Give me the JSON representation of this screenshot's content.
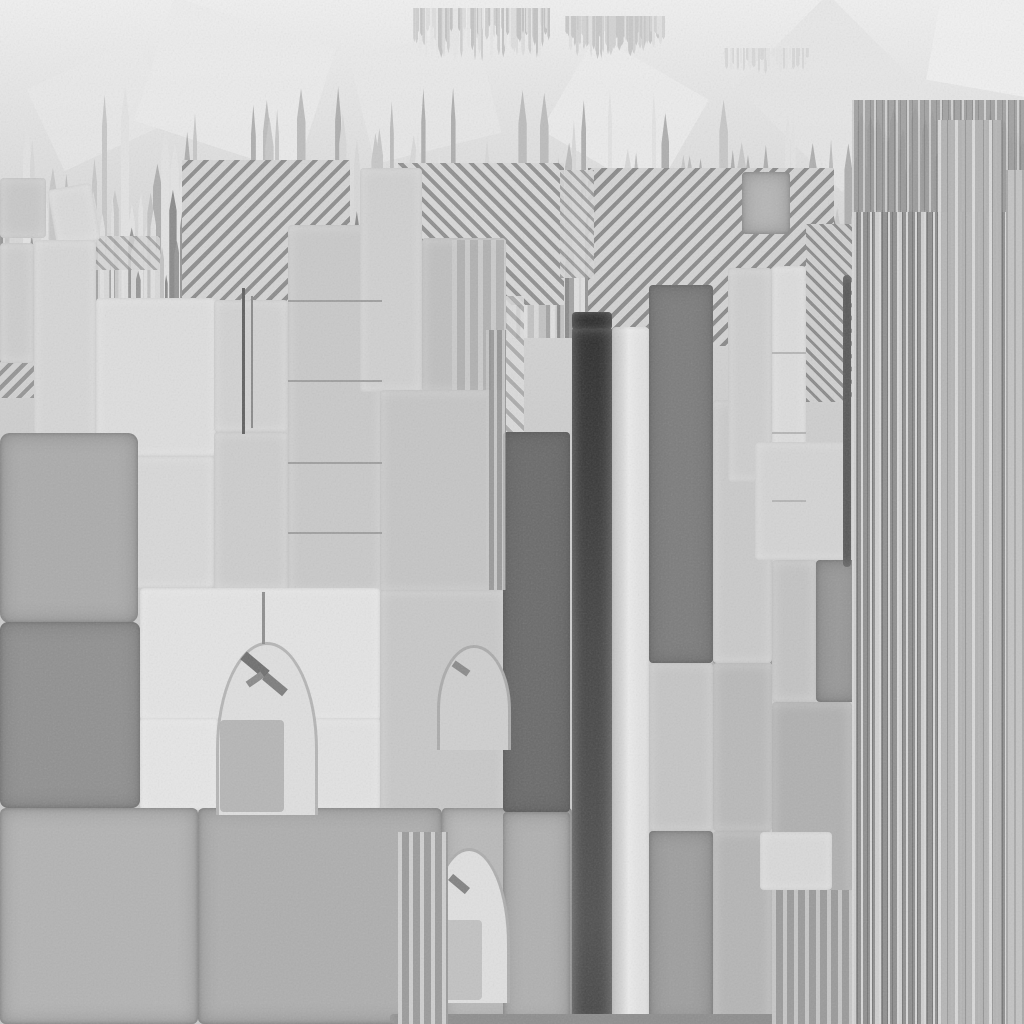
{
  "canvas": {
    "width": 1024,
    "height": 1024,
    "bg_gradient": [
      "#f0f0f0",
      "#e4e4e4",
      "#d6d6d6",
      "#cecece",
      "#c9c9c9"
    ],
    "bg_stops": [
      "0px",
      "110px",
      "250px",
      "420px",
      "1024px"
    ]
  },
  "palette": {
    "near_black": "#1e1e1e",
    "dark_bar": "#2d2d2d",
    "dark_block": "#6a6a6a",
    "mid_gray": "#9e9e9e",
    "light_block": "#d6d6d6",
    "bright_bar": "#eaeaea",
    "barcode_base": "#8f8f8f",
    "stripe_light": "#d8d8d8"
  },
  "faint_polys": [
    {
      "x": 150,
      "y": 20,
      "w": 170,
      "h": 130,
      "fill": "#ececec",
      "rot": 18,
      "op": 0.8
    },
    {
      "x": 360,
      "y": 40,
      "w": 130,
      "h": 110,
      "fill": "#e9e9e9",
      "rot": -14,
      "op": 0.7
    },
    {
      "x": 560,
      "y": 60,
      "w": 130,
      "h": 110,
      "fill": "#ededed",
      "rot": 30,
      "op": 0.8
    },
    {
      "x": 760,
      "y": 28,
      "w": 150,
      "h": 130,
      "fill": "#e6e6e6",
      "rot": 45,
      "op": 0.8
    },
    {
      "x": 935,
      "y": -20,
      "w": 110,
      "h": 110,
      "fill": "#f1f1f1",
      "rot": 10,
      "op": 0.9
    },
    {
      "x": 40,
      "y": 60,
      "w": 120,
      "h": 90,
      "fill": "#ebebeb",
      "rot": -25,
      "op": 0.6
    }
  ],
  "spike_bands": [
    {
      "name": "skyline-tall",
      "x0": 0,
      "x1": 868,
      "base": 330,
      "minH": 120,
      "maxH": 245,
      "minW": 4,
      "maxW": 9,
      "count": 95,
      "dir": "up",
      "seed": 13,
      "shades": [
        "#c7c7c7",
        "#d8d8d8",
        "#aeaeae",
        "#e3e3e3",
        "#bcbcbc"
      ]
    },
    {
      "name": "skyline-dense",
      "x0": 0,
      "x1": 868,
      "base": 338,
      "minH": 45,
      "maxH": 150,
      "minW": 3,
      "maxW": 8,
      "count": 180,
      "dir": "up",
      "seed": 7,
      "shades": [
        "#8a8a8a",
        "#a3a3a3",
        "#c2c2c2",
        "#d9d9d9",
        "#969696",
        "#e0e0e0"
      ]
    },
    {
      "name": "top-fringe-left",
      "x0": 412,
      "x1": 548,
      "y": 8,
      "minH": 18,
      "maxH": 54,
      "minW": 2,
      "maxW": 4,
      "count": 72,
      "dir": "down",
      "seed": 3,
      "shades": [
        "#cfcfcf",
        "#dedede",
        "#c3c3c3",
        "#e7e7e7"
      ]
    },
    {
      "name": "top-fringe-right",
      "x0": 565,
      "x1": 662,
      "y": 16,
      "minH": 14,
      "maxH": 44,
      "minW": 2,
      "maxW": 4,
      "count": 52,
      "dir": "down",
      "seed": 9,
      "shades": [
        "#d3d3d3",
        "#e1e1e1",
        "#c8c8c8"
      ]
    },
    {
      "name": "top-fringe-far-right",
      "x0": 722,
      "x1": 808,
      "y": 48,
      "minH": 8,
      "maxH": 26,
      "minW": 2,
      "maxW": 4,
      "count": 30,
      "dir": "down",
      "seed": 5,
      "shades": [
        "#d8d8d8",
        "#e4e4e4"
      ]
    },
    {
      "name": "barcode-towers",
      "x0": 852,
      "x1": 1020,
      "base": 218,
      "minH": 40,
      "maxH": 115,
      "minW": 4,
      "maxW": 9,
      "count": 46,
      "dir": "up",
      "seed": 21,
      "shades": [
        "#8e8e8e",
        "#a6a6a6",
        "#bdbdbd",
        "#979797"
      ]
    }
  ],
  "hatches": [
    {
      "x": 182,
      "y": 160,
      "w": 168,
      "h": 186,
      "angle": -45,
      "dark": "#8d8d8d",
      "light": "#d5d5d5",
      "period": 11,
      "op": 1
    },
    {
      "x": 398,
      "y": 163,
      "w": 166,
      "h": 142,
      "angle": 45,
      "dark": "#909090",
      "light": "#d8d8d8",
      "period": 10,
      "op": 1
    },
    {
      "x": 588,
      "y": 168,
      "w": 246,
      "h": 178,
      "angle": -45,
      "dark": "#8a8a8a",
      "light": "#d3d3d3",
      "period": 11,
      "op": 1
    },
    {
      "x": 560,
      "y": 170,
      "w": 34,
      "h": 108,
      "angle": 45,
      "dark": "#999999",
      "light": "#d6d6d6",
      "period": 9,
      "op": 0.9
    },
    {
      "x": 342,
      "y": 296,
      "w": 182,
      "h": 140,
      "angle": 45,
      "dark": "#a5a5a5",
      "light": "#dcdcdc",
      "period": 12,
      "op": 0.85
    },
    {
      "x": 0,
      "y": 314,
      "w": 92,
      "h": 84,
      "angle": -45,
      "dark": "#8e8e8e",
      "light": "#d2d2d2",
      "period": 10,
      "op": 0.9
    },
    {
      "x": 90,
      "y": 236,
      "w": 70,
      "h": 34,
      "angle": 45,
      "dark": "#9a9a9a",
      "light": "#d6d6d6",
      "period": 9,
      "op": 0.8
    },
    {
      "x": 806,
      "y": 224,
      "w": 46,
      "h": 178,
      "angle": 45,
      "dark": "#8b8b8b",
      "light": "#d0d0d0",
      "period": 9,
      "op": 1
    },
    {
      "x": 700,
      "y": 556,
      "w": 72,
      "h": 150,
      "angle": 45,
      "dark": "#8f8f8f",
      "light": "#cdcdcd",
      "period": 10,
      "op": 0.8
    },
    {
      "x": 690,
      "y": 660,
      "w": 80,
      "h": 120,
      "angle": -45,
      "dark": "#9a9a9a",
      "light": "#cfcfcf",
      "period": 12,
      "op": 0.5
    },
    {
      "x": 276,
      "y": 744,
      "w": 38,
      "h": 68,
      "angle": 45,
      "dark": "#777777",
      "light": "#cfcfcf",
      "period": 8,
      "op": 0.9
    },
    {
      "x": 338,
      "y": 820,
      "w": 96,
      "h": 52,
      "angle": 45,
      "dark": "#8a8a8a",
      "light": "#c6c6c6",
      "period": 9,
      "op": 0.75
    },
    {
      "x": 336,
      "y": 938,
      "w": 150,
      "h": 78,
      "angle": 45,
      "dark": "#9d9d9d",
      "light": "#d4d4d4",
      "period": 12,
      "op": 0.7
    }
  ],
  "blocks": [
    {
      "x": 0,
      "y": 178,
      "w": 46,
      "h": 60,
      "fill": "#c8c8c8"
    },
    {
      "x": 52,
      "y": 186,
      "w": 44,
      "h": 58,
      "fill": "#dadada",
      "rot": -10
    },
    {
      "x": 0,
      "y": 243,
      "w": 34,
      "h": 120,
      "fill": "#cdcdcd"
    },
    {
      "x": 34,
      "y": 240,
      "w": 62,
      "h": 216,
      "fill": "#d6d6d6"
    },
    {
      "x": 96,
      "y": 298,
      "w": 120,
      "h": 158,
      "fill": "#dedede"
    },
    {
      "x": 214,
      "y": 300,
      "w": 74,
      "h": 132,
      "fill": "#d2d2d2"
    },
    {
      "x": 288,
      "y": 225,
      "w": 94,
      "h": 368,
      "fill": "#c9c9c9"
    },
    {
      "x": 360,
      "y": 168,
      "w": 62,
      "h": 224,
      "fill": "#d0d0d0"
    },
    {
      "x": 422,
      "y": 238,
      "w": 84,
      "h": 154,
      "fill": "#bfbfbf"
    },
    {
      "x": 380,
      "y": 390,
      "w": 126,
      "h": 202,
      "fill": "#c5c5c5"
    },
    {
      "x": 214,
      "y": 432,
      "w": 74,
      "h": 158,
      "fill": "#cdcdcd"
    },
    {
      "x": 96,
      "y": 456,
      "w": 118,
      "h": 132,
      "fill": "#d8d8d8"
    },
    {
      "x": 33,
      "y": 456,
      "w": 63,
      "h": 132,
      "fill": "#dbdbdb"
    },
    {
      "x": 0,
      "y": 433,
      "w": 138,
      "h": 190,
      "fill": "#ababab",
      "r": 10,
      "vig": true
    },
    {
      "x": 0,
      "y": 622,
      "w": 140,
      "h": 186,
      "fill": "#909090",
      "r": 8,
      "vig": true
    },
    {
      "x": 140,
      "y": 588,
      "w": 240,
      "h": 132,
      "fill": "#e4e4e4"
    },
    {
      "x": 140,
      "y": 718,
      "w": 78,
      "h": 92,
      "fill": "#e6e6e6"
    },
    {
      "x": 310,
      "y": 718,
      "w": 70,
      "h": 92,
      "fill": "#e2e2e2"
    },
    {
      "x": 380,
      "y": 590,
      "w": 126,
      "h": 228,
      "fill": "#c8c8c8"
    },
    {
      "x": 0,
      "y": 808,
      "w": 198,
      "h": 216,
      "fill": "#b3b3b3",
      "r": 6,
      "vig": true
    },
    {
      "x": 198,
      "y": 808,
      "w": 244,
      "h": 216,
      "fill": "#aeaeae",
      "r": 6,
      "vig": true
    },
    {
      "x": 442,
      "y": 808,
      "w": 130,
      "h": 216,
      "fill": "#b9b9b9",
      "vig": true
    },
    {
      "x": 503,
      "y": 432,
      "w": 67,
      "h": 380,
      "fill": "#6a6a6a",
      "vig": true
    },
    {
      "x": 503,
      "y": 812,
      "w": 67,
      "h": 212,
      "fill": "#b0b0b0",
      "vig": true
    },
    {
      "x": 572,
      "y": 327,
      "w": 40,
      "h": 697,
      "grad": "linear-gradient(180deg,#2d2d2d,#454545 45%,#505050 85%,#474747)"
    },
    {
      "x": 572,
      "y": 312,
      "w": 40,
      "h": 18,
      "fill": "#1e1e1e"
    },
    {
      "x": 612,
      "y": 327,
      "w": 37,
      "h": 697,
      "grad": "linear-gradient(90deg,#b8b8b8,#ebebeb 45%,#dcdcdc)"
    },
    {
      "x": 649,
      "y": 285,
      "w": 64,
      "h": 378,
      "fill": "#7c7c7c",
      "vig": true
    },
    {
      "x": 649,
      "y": 663,
      "w": 64,
      "h": 168,
      "fill": "#c5c5c5"
    },
    {
      "x": 649,
      "y": 831,
      "w": 64,
      "h": 193,
      "fill": "#9e9e9e",
      "vig": true
    },
    {
      "x": 713,
      "y": 400,
      "w": 59,
      "h": 263,
      "fill": "#cacaca"
    },
    {
      "x": 713,
      "y": 663,
      "w": 59,
      "h": 168,
      "fill": "#b9b9b9"
    },
    {
      "x": 713,
      "y": 831,
      "w": 59,
      "h": 193,
      "fill": "#b5b5b5"
    },
    {
      "x": 742,
      "y": 172,
      "w": 48,
      "h": 62,
      "fill": "#b6b6b6",
      "vig": true
    },
    {
      "x": 728,
      "y": 268,
      "w": 44,
      "h": 214,
      "fill": "#cecece"
    },
    {
      "x": 772,
      "y": 266,
      "w": 34,
      "h": 296,
      "fill": "#dcdcdc"
    },
    {
      "x": 755,
      "y": 442,
      "w": 96,
      "h": 118,
      "fill": "#d4d4d4"
    },
    {
      "x": 772,
      "y": 560,
      "w": 44,
      "h": 142,
      "fill": "#c3c3c3"
    },
    {
      "x": 816,
      "y": 560,
      "w": 44,
      "h": 142,
      "fill": "#999999",
      "vig": true
    },
    {
      "x": 772,
      "y": 702,
      "w": 80,
      "h": 322,
      "fill": "#b0b0b0"
    },
    {
      "x": 760,
      "y": 832,
      "w": 72,
      "h": 58,
      "fill": "#d9d9d9"
    },
    {
      "x": 843,
      "y": 275,
      "w": 8,
      "h": 292,
      "fill": "#303030"
    },
    {
      "x": 390,
      "y": 1014,
      "w": 470,
      "h": 10,
      "fill": "#787878"
    }
  ],
  "arches": [
    {
      "x": 216,
      "y": 642,
      "w": 96,
      "h": 170,
      "fill": "#dfdfdf",
      "border": "#b5b5b5",
      "bw": 3
    },
    {
      "x": 437,
      "y": 645,
      "w": 68,
      "h": 102,
      "fill": "#cfcfcf",
      "border": "#ababab",
      "bw": 3
    },
    {
      "x": 428,
      "y": 848,
      "w": 76,
      "h": 152,
      "fill": "#e0e0e0",
      "border": "#adadad",
      "bw": 3
    }
  ],
  "arch_fill_columns": [
    {
      "x": 220,
      "y": 720,
      "w": 64,
      "h": 92,
      "fill": "#b6b6b6"
    },
    {
      "x": 432,
      "y": 920,
      "w": 50,
      "h": 80,
      "fill": "#c2c2c2"
    }
  ],
  "arch_glitches": [
    {
      "x": 240,
      "y": 660,
      "w": 30,
      "h": 10,
      "fill": "#6f6f6f",
      "rot": 40
    },
    {
      "x": 262,
      "y": 680,
      "w": 26,
      "h": 9,
      "fill": "#7d7d7d",
      "rot": 40
    },
    {
      "x": 246,
      "y": 676,
      "w": 18,
      "h": 7,
      "fill": "#8b8b8b",
      "rot": -35
    },
    {
      "x": 448,
      "y": 880,
      "w": 22,
      "h": 8,
      "fill": "#828282",
      "rot": 40
    },
    {
      "x": 452,
      "y": 665,
      "w": 18,
      "h": 7,
      "fill": "#8a8a8a",
      "rot": 35
    }
  ],
  "lines": [
    {
      "x": 262,
      "y": 592,
      "w": 3,
      "h": 52,
      "fill": "#8f8f8f"
    },
    {
      "x": 242,
      "y": 288,
      "w": 3,
      "h": 146,
      "fill": "#606060"
    },
    {
      "x": 251,
      "y": 296,
      "w": 2,
      "h": 132,
      "fill": "#8a8a8a"
    },
    {
      "x": 288,
      "y": 300,
      "w": 94,
      "h": 2,
      "fill": "#9f9f9f"
    },
    {
      "x": 288,
      "y": 380,
      "w": 94,
      "h": 2,
      "fill": "#9f9f9f"
    },
    {
      "x": 288,
      "y": 462,
      "w": 94,
      "h": 2,
      "fill": "#9f9f9f"
    },
    {
      "x": 288,
      "y": 532,
      "w": 94,
      "h": 2,
      "fill": "#9f9f9f"
    },
    {
      "x": 772,
      "y": 352,
      "w": 34,
      "h": 2,
      "fill": "#b5b5b5"
    },
    {
      "x": 772,
      "y": 432,
      "w": 34,
      "h": 2,
      "fill": "#b5b5b5"
    },
    {
      "x": 772,
      "y": 500,
      "w": 34,
      "h": 2,
      "fill": "#b5b5b5"
    },
    {
      "x": 852,
      "y": 388,
      "w": 172,
      "h": 3,
      "fill": "#bdbdbd"
    },
    {
      "x": 852,
      "y": 520,
      "w": 172,
      "h": 3,
      "fill": "#b5b5b5"
    },
    {
      "x": 938,
      "y": 762,
      "w": 86,
      "h": 3,
      "fill": "#c0c0c0"
    },
    {
      "x": 852,
      "y": 838,
      "w": 172,
      "h": 3,
      "fill": "#ababab"
    },
    {
      "x": 938,
      "y": 918,
      "w": 86,
      "h": 3,
      "fill": "#c4c4c4"
    }
  ],
  "vstripe_regions": [
    {
      "name": "barcode-main",
      "x": 852,
      "y": 210,
      "w": 172,
      "h": 814,
      "base": "#8f8f8f",
      "lines": [
        [
          "#d8d8d8",
          2,
          9
        ],
        [
          "#cfcfcf",
          4,
          23
        ],
        [
          "#767676",
          1,
          5
        ]
      ],
      "op": 1
    },
    {
      "name": "barcode-top",
      "x": 852,
      "y": 100,
      "w": 172,
      "h": 112,
      "base": "#9b9b9b",
      "lines": [
        [
          "#cfcfcf",
          2,
          11
        ],
        [
          "#858585",
          1,
          6
        ]
      ],
      "op": 0.9
    },
    {
      "name": "barcode-light-band",
      "x": 938,
      "y": 120,
      "w": 64,
      "h": 904,
      "base": "#b5b5b5",
      "lines": [
        [
          "#dddddd",
          3,
          17
        ],
        [
          "#969696",
          1,
          9
        ]
      ],
      "op": 0.95
    },
    {
      "name": "barcode-right-edge",
      "x": 1006,
      "y": 170,
      "w": 18,
      "h": 854,
      "base": "#c3c3c3",
      "lines": [
        [
          "#a9a9a9",
          2,
          8
        ]
      ],
      "op": 1
    },
    {
      "name": "glitch-strip-arch3",
      "x": 398,
      "y": 832,
      "w": 50,
      "h": 192,
      "base": "#9b9b9b",
      "lines": [
        [
          "#cfcfcf",
          4,
          11
        ]
      ],
      "op": 1
    },
    {
      "name": "glitch-strip-mid",
      "x": 452,
      "y": 240,
      "w": 54,
      "h": 150,
      "base": "#a8a8a8",
      "lines": [
        [
          "#d2d2d2",
          5,
          13
        ]
      ],
      "op": 0.6
    },
    {
      "name": "glitch-strip-center",
      "x": 486,
      "y": 330,
      "w": 20,
      "h": 260,
      "base": "#8f8f8f",
      "lines": [
        [
          "#c9c9c9",
          3,
          8
        ]
      ],
      "op": 0.8
    },
    {
      "name": "glitch-strip-bottom-right",
      "x": 772,
      "y": 890,
      "w": 80,
      "h": 134,
      "base": "#9a9a9a",
      "lines": [
        [
          "#c6c6c6",
          4,
          11
        ]
      ],
      "op": 1
    }
  ],
  "noise": {
    "opacity": 0.16,
    "frequency": 0.6,
    "octaves": 2
  }
}
